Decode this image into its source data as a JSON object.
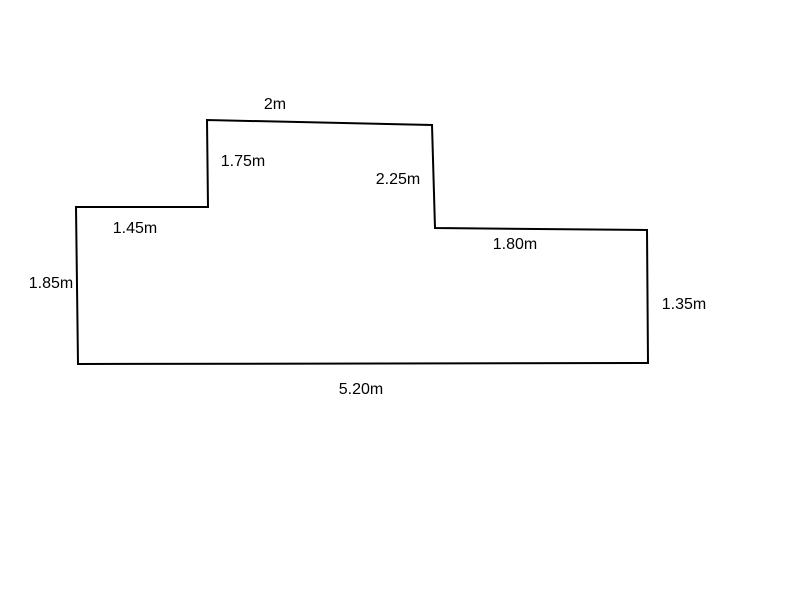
{
  "diagram": {
    "type": "polygon-dimension-drawing",
    "description": "Closed irregular rectilinear outline (floor-plan style) with a raised section at the top, hand-drawn look with slightly slanted edges, annotated with edge length labels",
    "background_color": "#ffffff",
    "stroke_color": "#000000",
    "stroke_width": 2,
    "shape": {
      "vertices": [
        [
          76,
          207
        ],
        [
          208,
          207
        ],
        [
          207,
          120
        ],
        [
          432,
          125
        ],
        [
          435,
          228
        ],
        [
          647,
          230
        ],
        [
          648,
          363
        ],
        [
          78,
          364
        ]
      ]
    },
    "labels": [
      {
        "text": "2m",
        "x": 275,
        "y": 105,
        "edge": "top-of-raised-section"
      },
      {
        "text": "1.75m",
        "x": 243,
        "y": 162,
        "edge": "left-side-of-raised-section"
      },
      {
        "text": "2.25m",
        "x": 398,
        "y": 180,
        "edge": "right-side-of-raised-section"
      },
      {
        "text": "1.45m",
        "x": 135,
        "y": 229,
        "edge": "upper-left-ledge"
      },
      {
        "text": "1.80m",
        "x": 515,
        "y": 245,
        "edge": "upper-right-ledge"
      },
      {
        "text": "1.85m",
        "x": 51,
        "y": 284,
        "edge": "left-wall"
      },
      {
        "text": "1.35m",
        "x": 684,
        "y": 305,
        "edge": "right-wall"
      },
      {
        "text": "5.20m",
        "x": 361,
        "y": 390,
        "edge": "bottom-wall"
      }
    ]
  }
}
